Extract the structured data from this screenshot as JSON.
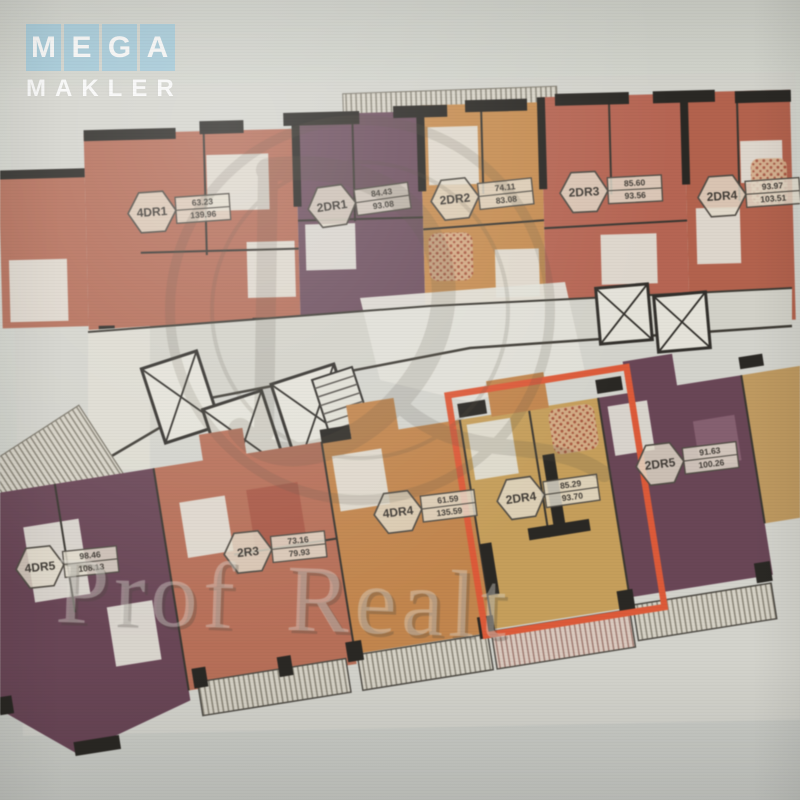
{
  "brand": {
    "logo_word": "MEGA",
    "logo_letters": [
      "M",
      "E",
      "G",
      "A"
    ],
    "logo_subtitle": "MAKLER",
    "logo_tile_color": "#9fc9da"
  },
  "watermark": {
    "agency": "Prof Realt",
    "emblem_icon": "circular-monogram"
  },
  "floor_plan": {
    "highlighted_unit": "2DR4",
    "highlight_color": "#f2542b",
    "wall_color": "#24211c",
    "units": [
      {
        "name": "4DR1",
        "area_top": "63.23",
        "area_bottom": "139.96",
        "color": "#bf684f",
        "wing": "top",
        "highlighted": false
      },
      {
        "name": "2DR1",
        "area_top": "84.43",
        "area_bottom": "93.08",
        "color": "#6f4a5c",
        "wing": "top",
        "highlighted": false
      },
      {
        "name": "2DR2",
        "area_top": "74.11",
        "area_bottom": "83.08",
        "color": "#d18c44",
        "wing": "top",
        "highlighted": false
      },
      {
        "name": "2DR3",
        "area_top": "85.60",
        "area_bottom": "93.56",
        "color": "#c2614b",
        "wing": "top",
        "highlighted": false
      },
      {
        "name": "2DR4",
        "area_top": "93.97",
        "area_bottom": "103.51",
        "color": "#bf5d44",
        "wing": "top",
        "highlighted": false
      },
      {
        "name": "4DR5",
        "area_top": "98.46",
        "area_bottom": "108.13",
        "color": "#6b4054",
        "wing": "bottom",
        "highlighted": false
      },
      {
        "name": "2R3",
        "area_top": "73.16",
        "area_bottom": "79.93",
        "color": "#c36c50",
        "wing": "bottom",
        "highlighted": false
      },
      {
        "name": "4DR4",
        "area_top": "61.59",
        "area_bottom": "135.59",
        "color": "#cd8440",
        "wing": "bottom",
        "highlighted": false
      },
      {
        "name": "2DR4",
        "area_top": "85.29",
        "area_bottom": "93.70",
        "color": "#cfa04e",
        "wing": "bottom",
        "highlighted": true
      },
      {
        "name": "2DR5",
        "area_top": "91.63",
        "area_bottom": "100.26",
        "color": "#6b4054",
        "wing": "bottom",
        "highlighted": false
      }
    ]
  }
}
